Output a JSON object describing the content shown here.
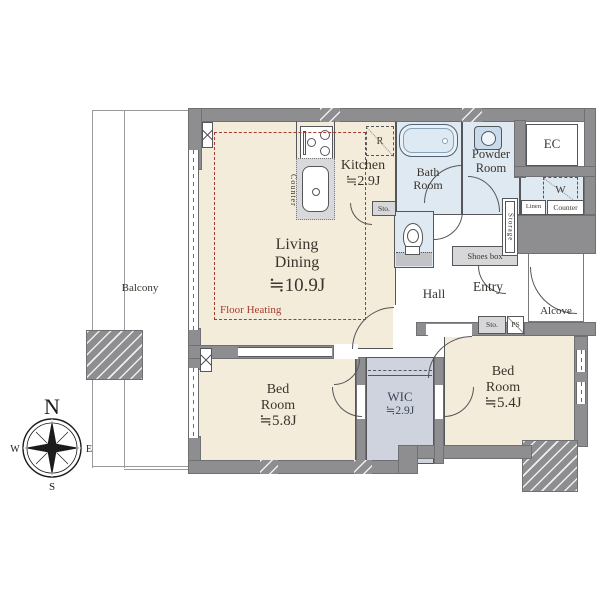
{
  "rooms": {
    "living": {
      "l1": "Living",
      "l2": "Dining",
      "area": "≒10.9J"
    },
    "kitchen": {
      "name": "Kitchen",
      "area": "≒2.9J"
    },
    "bath": {
      "l1": "Bath",
      "l2": "Room"
    },
    "powder": {
      "l1": "Powder",
      "l2": "Room"
    },
    "bed1": {
      "l1": "Bed",
      "l2": "Room",
      "area": "≒5.8J"
    },
    "bed2": {
      "l1": "Bed",
      "l2": "Room",
      "area": "≒5.4J"
    },
    "wic": {
      "name": "WIC",
      "area": "≒2.9J"
    },
    "hall": "Hall",
    "entry": "Entry",
    "alcove": "Alcove",
    "balcony": "Balcony",
    "ec": "EC"
  },
  "labels": {
    "floor_heating": "Floor Heating",
    "counter_kitchen": "Counter",
    "refrigerator": "R",
    "washer": "W",
    "storage": "Storage",
    "linen": "Linen",
    "counter_right": "Counter",
    "shoes_box": "Shoes box",
    "sto_kitchen": "Sto.",
    "sto_entry": "Sto.",
    "ps": "PS"
  },
  "compass": {
    "n": "N",
    "e": "E",
    "s": "S",
    "w": "W"
  },
  "colors": {
    "floor_beige": "#f4ecda",
    "floor_wet": "#dfe9f2",
    "floor_wic": "#ced3de",
    "wall_gray": "#8e8e90",
    "line": "#55565a",
    "floor_heating_red": "#a63c2e",
    "text": "#3a342d",
    "wic_text": "#3c4458"
  }
}
